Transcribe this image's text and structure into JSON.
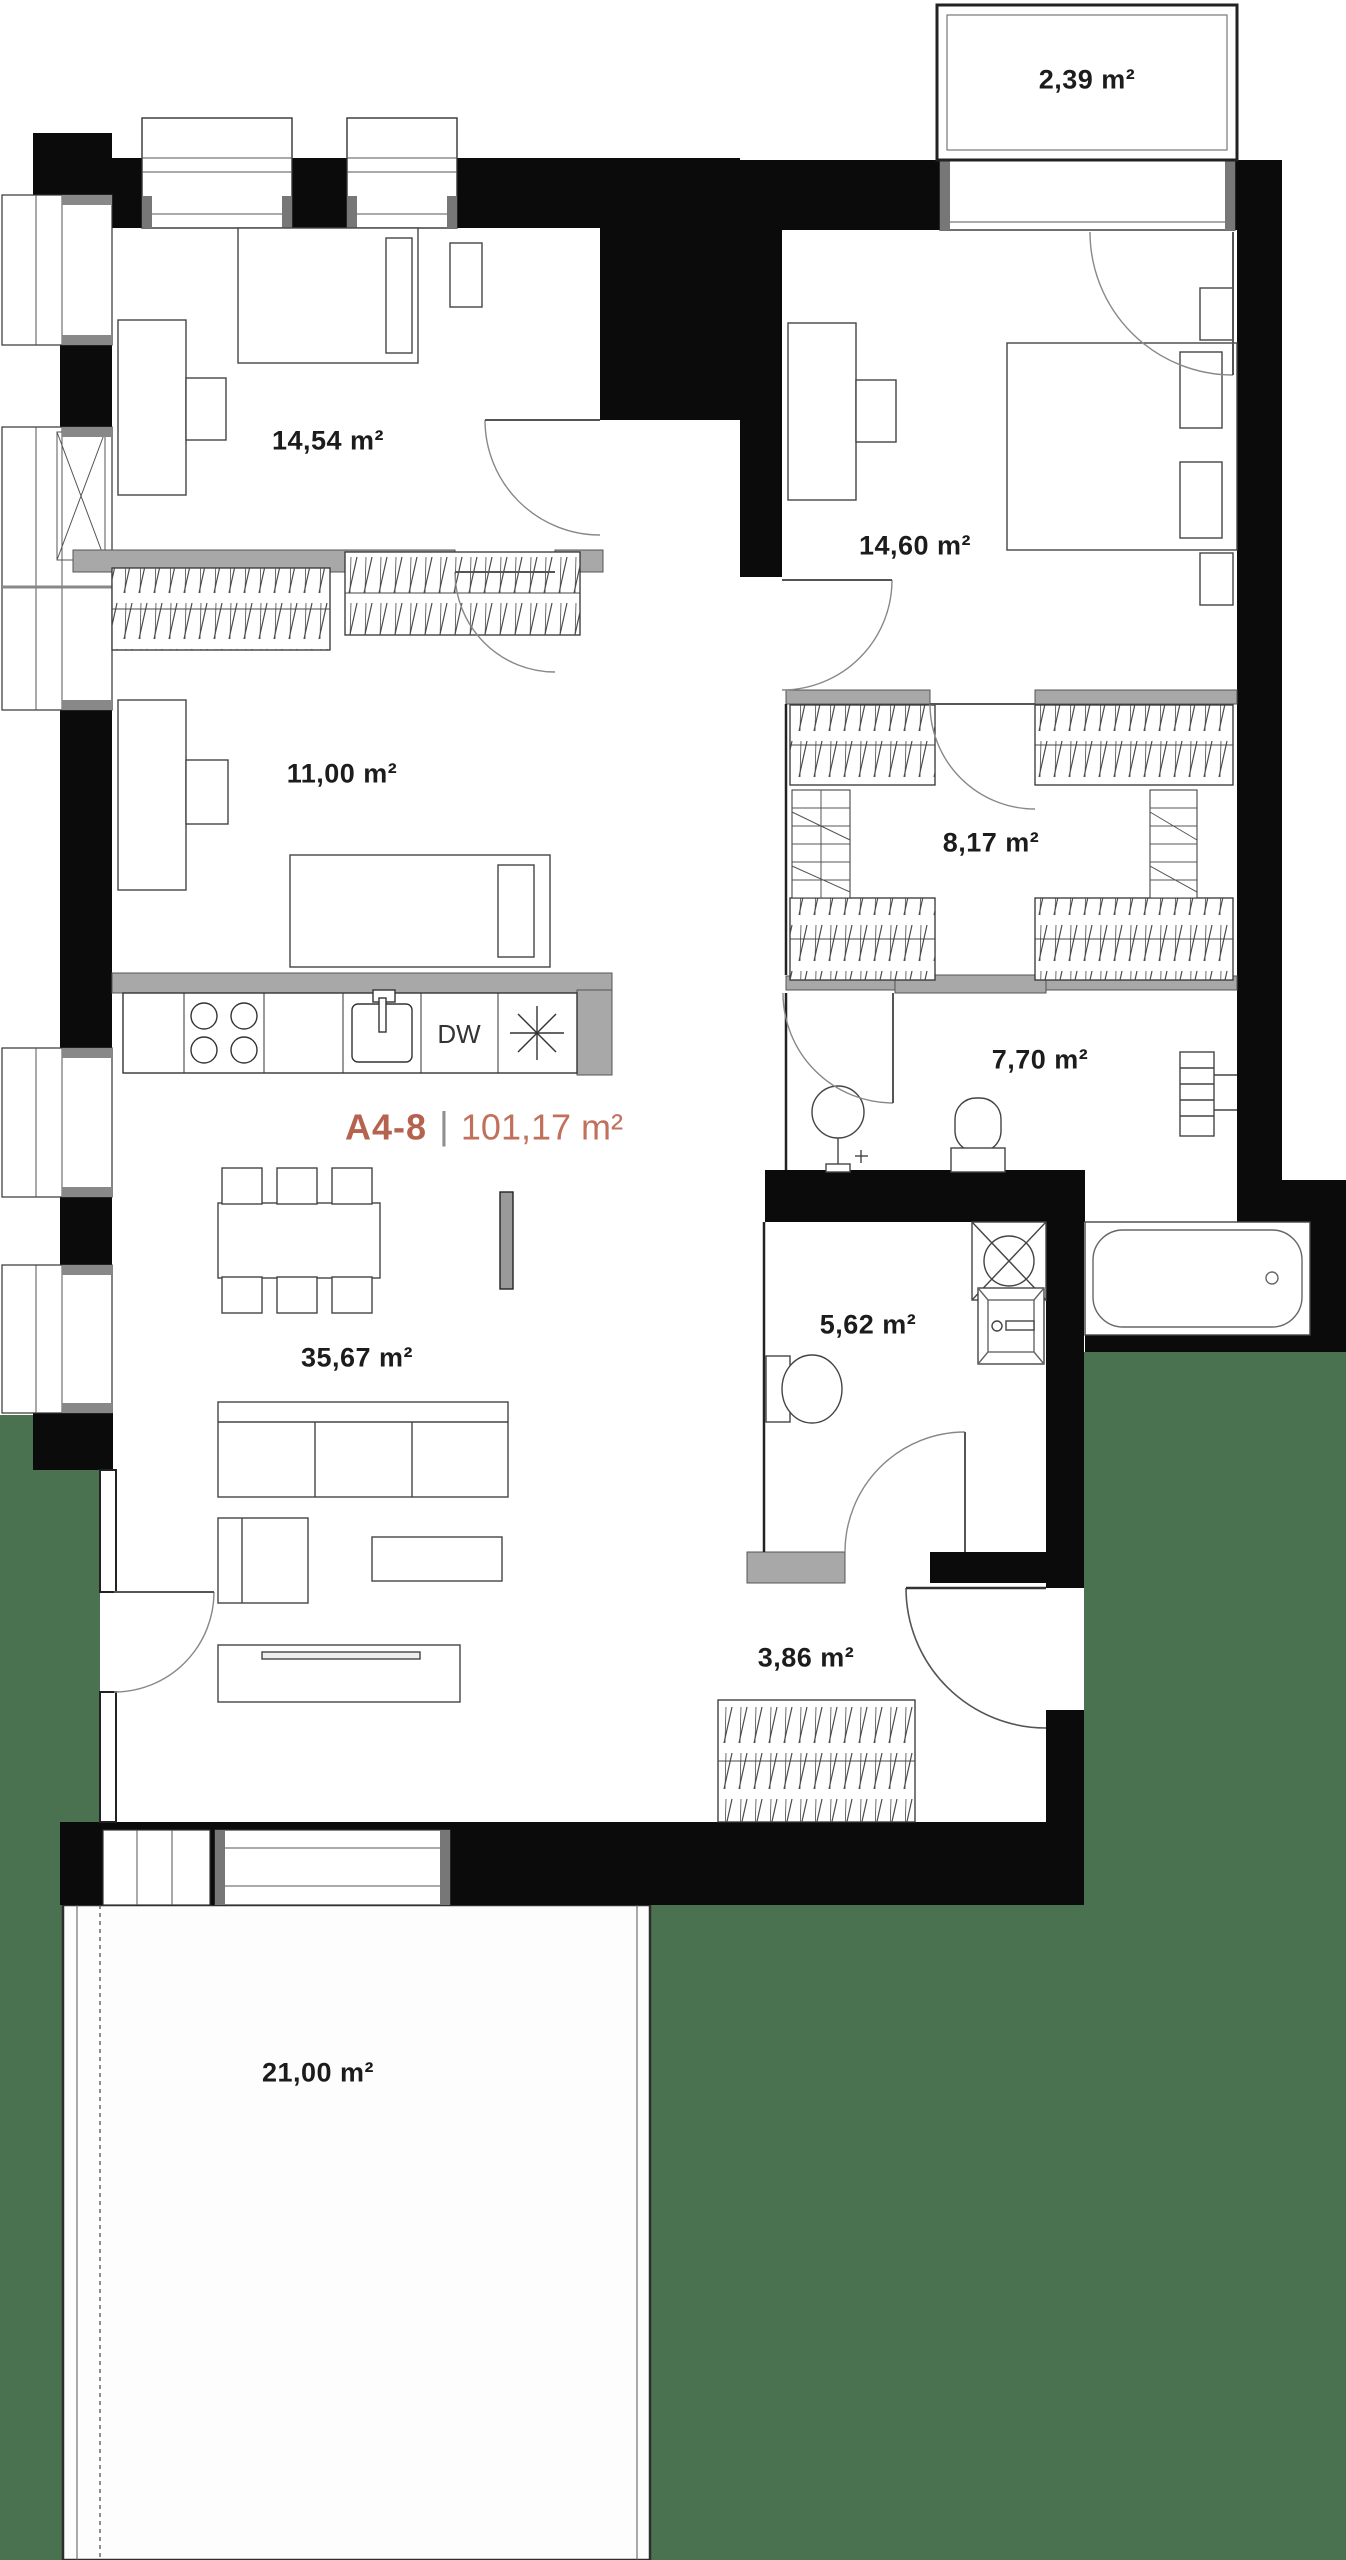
{
  "unit": {
    "code": "A4-8",
    "separator": "|",
    "area": "101,17 m²"
  },
  "rooms": {
    "balcony": {
      "area": "2,39 m²"
    },
    "bedroom1": {
      "area": "14,54 m²"
    },
    "bedroom2": {
      "area": "14,60 m²"
    },
    "bedroom3": {
      "area": "11,00 m²"
    },
    "closet": {
      "area": "8,17 m²"
    },
    "bathroom": {
      "area": "7,70 m²"
    },
    "wc": {
      "area": "5,62 m²"
    },
    "living": {
      "area": "35,67 m²"
    },
    "hall": {
      "area": "3,86 m²"
    },
    "terrace": {
      "area": "21,00 m²"
    }
  },
  "kitchen": {
    "dishwasher_label": "DW"
  },
  "colors": {
    "accent": "#b5624f",
    "accent_light": "#c1705c",
    "exterior_green": "#4a7150",
    "wall": "#0b0b0b",
    "partition": "#a8a8a8"
  }
}
